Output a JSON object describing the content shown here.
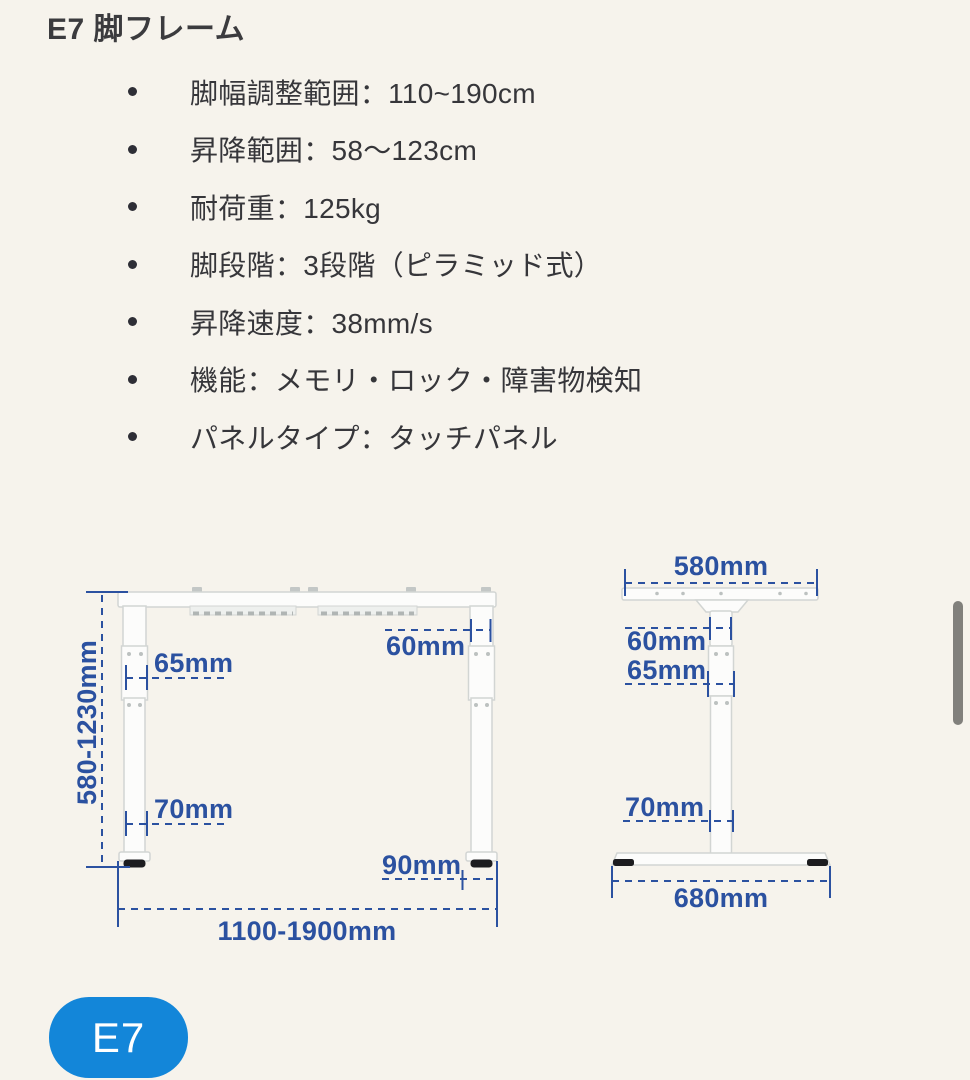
{
  "page": {
    "title": "E7 脚フレーム",
    "specs": [
      "脚幅調整範囲：110~190cm",
      "昇降範囲：58〜123cm",
      "耐荷重：125kg",
      "脚段階：3段階（ピラミッド式）",
      "昇降速度：38mm/s",
      "機能：メモリ・ロック・障害物検知",
      "パネルタイプ：タッチパネル"
    ],
    "badge_label": "E7"
  },
  "diagram": {
    "front_view": {
      "height_range": "580-1230mm",
      "width_range": "1100-1900mm",
      "top_column_width": "60mm",
      "mid_column_width": "65mm",
      "bottom_column_width": "70mm",
      "foot_width": "90mm"
    },
    "side_view": {
      "top_bracket_width": "580mm",
      "column_top_width": "60mm",
      "column_mid_width": "65mm",
      "column_bottom_width": "70mm",
      "base_depth": "680mm"
    }
  },
  "colors": {
    "background": "#f6f3ec",
    "body_text": "#36363a",
    "dimension_blue": "#2b51a0",
    "badge_blue": "#1386d9",
    "frame_white": "#fcfcfb",
    "foot_black": "#1c1c1f"
  }
}
